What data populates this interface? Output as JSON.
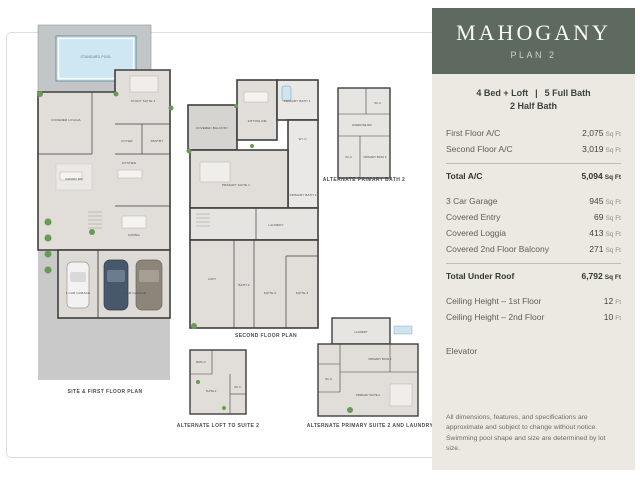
{
  "panel": {
    "title": "MAHOGANY",
    "subtitle": "PLAN 2",
    "summary": {
      "beds": "4 Bed + Loft",
      "sep": "|",
      "baths": "5 Full Bath",
      "line2": "2 Half Bath"
    },
    "rows": [
      {
        "label": "First Floor A/C",
        "value": "2,075",
        "unit": "Sq Ft"
      },
      {
        "label": "Second Floor A/C",
        "value": "3,019",
        "unit": "Sq Ft"
      },
      {
        "label": "Total A/C",
        "value": "5,094",
        "unit": "Sq Ft"
      },
      {
        "label": "3 Car Garage",
        "value": "945",
        "unit": "Sq Ft"
      },
      {
        "label": "Covered Entry",
        "value": "69",
        "unit": "Sq Ft"
      },
      {
        "label": "Covered Loggia",
        "value": "413",
        "unit": "Sq Ft"
      },
      {
        "label": "Covered 2nd Floor Balcony",
        "value": "271",
        "unit": "Sq Ft"
      },
      {
        "label": "Total Under Roof",
        "value": "6,792",
        "unit": "Sq Ft"
      },
      {
        "label": "Ceiling Height – 1st Floor",
        "value": "12",
        "unit": "Ft"
      },
      {
        "label": "Ceiling Height – 2nd Floor",
        "value": "10",
        "unit": "Ft"
      },
      {
        "label": "Elevator",
        "value": "",
        "unit": ""
      }
    ],
    "disclaimer": "All dimensions, features, and specifications are approximate and subject to change without notice. Swimming pool shape and size are determined by lot size.",
    "colors": {
      "header_bg": "#5e6a5f",
      "panel_bg": "#ece9e2",
      "title_text": "#fbfaf7"
    }
  },
  "plans": {
    "first_floor": {
      "caption": "SITE & FIRST FLOOR PLAN",
      "pool_label": "STANDARD POOL",
      "rooms": [
        "COVERED LOGGIA",
        "STUDY SUITE 4",
        "FOYER",
        "PANTRY",
        "GRAND RM",
        "KITCHEN",
        "DINING",
        "1 CAR GARAGE",
        "2 CAR GARAGE"
      ]
    },
    "second_floor": {
      "caption": "SECOND FLOOR PLAN",
      "rooms": [
        "COVERED BALCONY",
        "SITTING RM",
        "PRIMARY BATH 1",
        "W.I.C.",
        "PRIMARY SUITE 1",
        "PRIMARY BATH 2",
        "LAUNDRY",
        "LOFT",
        "BATH 2",
        "SUITE 2",
        "SUITE 3"
      ]
    },
    "alt_primary_bath": {
      "caption": "ALTERNATE PRIMARY BATH 2",
      "rooms": [
        "W.I.C.",
        "EXERCISE RM",
        "W.I.C.",
        "PRIMARY BATH 2"
      ]
    },
    "alt_loft": {
      "caption": "ALTERNATE LOFT TO SUITE 2",
      "rooms": [
        "BATH 2",
        "SUITE 2",
        "W.I.C."
      ]
    },
    "alt_primary_suite": {
      "caption": "ALTERNATE PRIMARY SUITE 2 AND LAUNDRY",
      "rooms": [
        "LAUNDRY",
        "PRIMARY BATH 2",
        "W.I.C.",
        "PRIMARY SUITE 2"
      ]
    }
  }
}
